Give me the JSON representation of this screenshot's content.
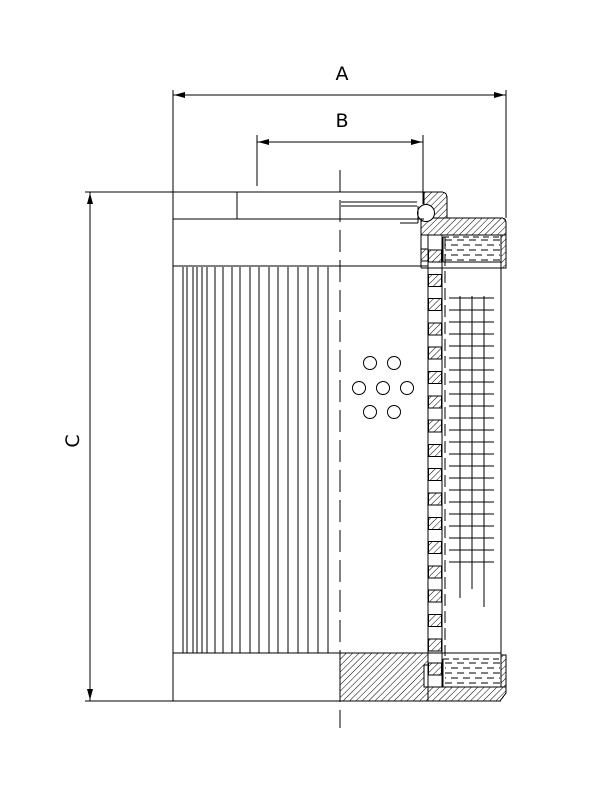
{
  "page": {
    "width": 612,
    "height": 792,
    "background": "#ffffff",
    "line_color": "#000000"
  },
  "dimensions": {
    "a": "A",
    "b": "B",
    "c": "C"
  },
  "geometry": {
    "solid_lines": [
      [
        85,
        192,
        441,
        192
      ],
      [
        173,
        219,
        424,
        219
      ],
      [
        173,
        266,
        428,
        266
      ],
      [
        173,
        90,
        173,
        701
      ],
      [
        506,
        90,
        506,
        218
      ],
      [
        237,
        192,
        237,
        219
      ],
      [
        341,
        202,
        417,
        202
      ],
      [
        341,
        206,
        417,
        206
      ],
      [
        400,
        223,
        418,
        223
      ],
      [
        418,
        206,
        418,
        223
      ],
      [
        421,
        235,
        421,
        268
      ],
      [
        428,
        235,
        428,
        687
      ],
      [
        442,
        235,
        442,
        687
      ],
      [
        421,
        268,
        506,
        268
      ],
      [
        501,
        268,
        501,
        655
      ],
      [
        173,
        653,
        501,
        653
      ],
      [
        85,
        701,
        501,
        701
      ],
      [
        506,
        655,
        506,
        693
      ],
      [
        443,
        237,
        443,
        262
      ],
      [
        501,
        237,
        501,
        262
      ],
      [
        443,
        262,
        501,
        262
      ],
      [
        443,
        659,
        443,
        687
      ],
      [
        501,
        659,
        501,
        687
      ],
      [
        443,
        687,
        501,
        687
      ],
      [
        257,
        135,
        257,
        186
      ],
      [
        423,
        135,
        423,
        204
      ],
      [
        173,
        95,
        506,
        95
      ],
      [
        257,
        142,
        423,
        142
      ],
      [
        90,
        192,
        90,
        701
      ]
    ],
    "dashed_lines": [
      {
        "x1": 340,
        "y1": 170,
        "x2": 340,
        "y2": 728,
        "dash": "22,8"
      },
      {
        "x1": 445,
        "y1": 237,
        "x2": 445,
        "y2": 656,
        "dash": "12,5"
      },
      {
        "x1": 443,
        "y1": 237,
        "x2": 501,
        "y2": 237,
        "dash": "6,4"
      },
      {
        "x1": 443,
        "y1": 659,
        "x2": 501,
        "y2": 659,
        "dash": "6,4"
      }
    ],
    "hatch_paths": [
      {
        "name": "top-boss-wall",
        "d": "M424,218 L424,192 L441,192 Q447,192 447,198 L447,218 Z"
      },
      {
        "name": "top-flange",
        "d": "M421,235 L421,218 L501,218 Q506,218 506,223 L506,235 Z"
      },
      {
        "name": "cap-skirt-band",
        "d": "M421,249 L428,249 L428,261 L421,261 Z"
      },
      {
        "name": "top-right-lip",
        "d": "M501,235 L506,235 L506,268 L501,268 Z"
      },
      {
        "name": "bottom-cap-block",
        "d": "M340,653 L428,653 L428,665 L424,665 L424,687 L428,687 L428,701 L340,701 Z"
      },
      {
        "name": "bottom-right-lip",
        "d": "M501,655 L506,655 L506,687 L501,687 Z"
      },
      {
        "name": "bottom-floor",
        "d": "M428,687 L506,687 L506,693 L500,701 L428,701 Z"
      }
    ],
    "core_tube": {
      "x": 428.5,
      "w": 13,
      "y0": 250,
      "step": 24.3,
      "h": 12,
      "count": 18
    },
    "pleats": {
      "xs": [
        183,
        187,
        193,
        197,
        202,
        207,
        215,
        223,
        232,
        240,
        250,
        259,
        269,
        278,
        288,
        298,
        308,
        318,
        328
      ],
      "y1": 267,
      "y2": 653
    },
    "mesh": {
      "verticals": [
        [
          460,
          296,
          598
        ],
        [
          472,
          296,
          589
        ],
        [
          484,
          296,
          607
        ]
      ],
      "h_x1": 449,
      "h_x2": 494,
      "h_y0": 298,
      "h_step": 12,
      "h_count": 23
    },
    "holes": {
      "r": 6.5,
      "centers": [
        [
          370,
          363
        ],
        [
          394,
          363
        ],
        [
          359,
          388
        ],
        [
          383,
          388
        ],
        [
          407,
          388
        ],
        [
          370,
          412
        ],
        [
          394,
          412
        ]
      ]
    },
    "o_ring": {
      "cx": 426,
      "cy": 213,
      "r": 8.5
    },
    "gaskets": [
      {
        "x1": 445,
        "x2": 500,
        "rows": [
          240,
          245,
          250,
          255,
          260
        ]
      },
      {
        "x1": 445,
        "x2": 500,
        "rows": [
          663,
          668,
          673,
          678,
          683
        ]
      }
    ],
    "arrows": [
      {
        "x": 174,
        "y": 95,
        "dir": "left"
      },
      {
        "x": 505,
        "y": 95,
        "dir": "right"
      },
      {
        "x": 258,
        "y": 142,
        "dir": "left"
      },
      {
        "x": 422,
        "y": 142,
        "dir": "right"
      },
      {
        "x": 90,
        "y": 193,
        "dir": "up"
      },
      {
        "x": 90,
        "y": 700,
        "dir": "down"
      }
    ]
  }
}
